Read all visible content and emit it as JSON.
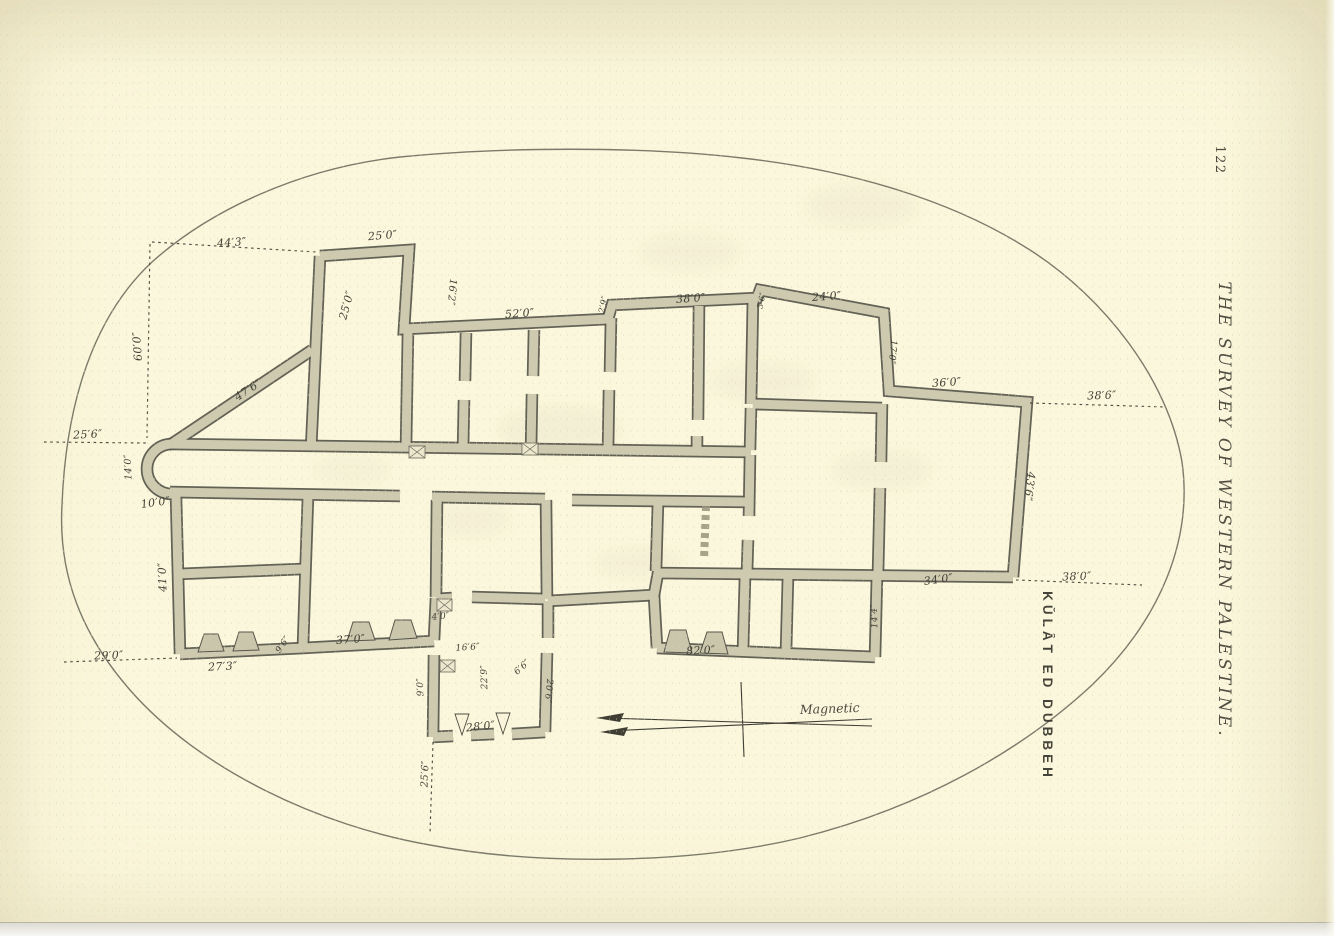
{
  "page": {
    "number": "122",
    "running_title": "THE SURVEY OF WESTERN PALESTINE.",
    "plan_title": "KŬLÂT ED DUBBEH",
    "compass_label": "Magnetic"
  },
  "colors": {
    "paper": "#fbf7dc",
    "wall_fill": "#cdcab0",
    "wall_outline": "#56554a",
    "ink": "#403f35"
  },
  "plan": {
    "labels": [
      {
        "t": "44′3″",
        "x": 232,
        "y": 246,
        "r": -4
      },
      {
        "t": "25′0″",
        "x": 383,
        "y": 239,
        "r": -5
      },
      {
        "t": "25′0″",
        "x": 350,
        "y": 306,
        "r": -75
      },
      {
        "t": "16′2″",
        "x": 449,
        "y": 292,
        "r": 95,
        "s": 10
      },
      {
        "t": "60′0″",
        "x": 141,
        "y": 346,
        "r": -94
      },
      {
        "t": "47′6″",
        "x": 250,
        "y": 393,
        "r": -33
      },
      {
        "t": "52′0″",
        "x": 520,
        "y": 317,
        "r": -4
      },
      {
        "t": "2′9″",
        "x": 606,
        "y": 305,
        "r": -78,
        "s": 8.5
      },
      {
        "t": "38′0″",
        "x": 691,
        "y": 302,
        "r": -4
      },
      {
        "t": "3′6″",
        "x": 764,
        "y": 301,
        "r": -78,
        "s": 8
      },
      {
        "t": "24′0″",
        "x": 827,
        "y": 300,
        "r": -4
      },
      {
        "t": "17′0″",
        "x": 890,
        "y": 352,
        "r": 95,
        "s": 9
      },
      {
        "t": "36′0″",
        "x": 947,
        "y": 386,
        "r": -4
      },
      {
        "t": "38′6″",
        "x": 1102,
        "y": 399,
        "r": -2
      },
      {
        "t": "43′6″",
        "x": 1026,
        "y": 486,
        "r": 97
      },
      {
        "t": "25′6″",
        "x": 88,
        "y": 438,
        "r": -3
      },
      {
        "t": "14′0″",
        "x": 131,
        "y": 467,
        "r": -92,
        "s": 9.5
      },
      {
        "t": "10′0″",
        "x": 156,
        "y": 506,
        "r": -8
      },
      {
        "t": "41′0″",
        "x": 166,
        "y": 577,
        "r": -92
      },
      {
        "t": "29′0″",
        "x": 109,
        "y": 659,
        "r": -2
      },
      {
        "t": "27′3″",
        "x": 223,
        "y": 670,
        "r": -3
      },
      {
        "t": "9′6″",
        "x": 285,
        "y": 646,
        "r": -55,
        "s": 9
      },
      {
        "t": "37′0″",
        "x": 351,
        "y": 643,
        "r": -4
      },
      {
        "t": "4′0″",
        "x": 441,
        "y": 619,
        "r": -6,
        "s": 9
      },
      {
        "t": "16′6″",
        "x": 468,
        "y": 650,
        "r": -4,
        "s": 9
      },
      {
        "t": "22′9″",
        "x": 487,
        "y": 677,
        "r": -92,
        "s": 9
      },
      {
        "t": "9′0″",
        "x": 423,
        "y": 687,
        "r": -92,
        "s": 9
      },
      {
        "t": "6′6″",
        "x": 524,
        "y": 669,
        "r": -42,
        "s": 9
      },
      {
        "t": "20′6″",
        "x": 546,
        "y": 691,
        "r": 95,
        "s": 9
      },
      {
        "t": "28′0″",
        "x": 481,
        "y": 730,
        "r": -6
      },
      {
        "t": "25′6″",
        "x": 428,
        "y": 774,
        "r": -88,
        "s": 10
      },
      {
        "t": "34′0″",
        "x": 939,
        "y": 583,
        "r": -8
      },
      {
        "t": "14′4″",
        "x": 877,
        "y": 616,
        "r": -92,
        "s": 9
      },
      {
        "t": "82′0″",
        "x": 701,
        "y": 654,
        "r": -3
      },
      {
        "t": "38′0″",
        "x": 1077,
        "y": 580,
        "r": -2
      }
    ]
  }
}
